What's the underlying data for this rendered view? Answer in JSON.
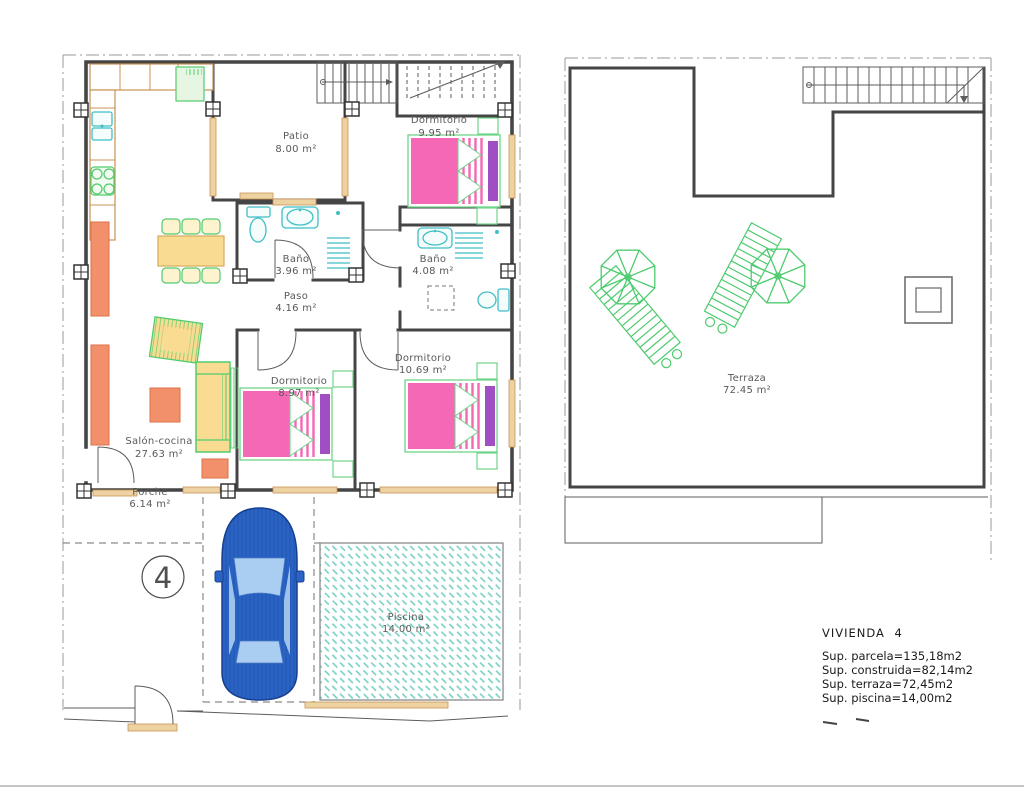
{
  "ground_floor": {
    "plot_number": "4",
    "rooms": [
      {
        "name": "Patio",
        "area": "8.00 m²"
      },
      {
        "name": "Dormitorio",
        "area": "9.95 m²"
      },
      {
        "name": "Baño",
        "area": "3.96 m²"
      },
      {
        "name": "Baño",
        "area": "4.08 m²"
      },
      {
        "name": "Paso",
        "area": "4.16 m²"
      },
      {
        "name": "Dormitorio",
        "area": "8.97 m²"
      },
      {
        "name": "Dormitorio",
        "area": "10.69 m²"
      },
      {
        "name": "Salón-cocina",
        "area": "27.63 m²"
      },
      {
        "name": "Porche",
        "area": "6.14 m²"
      },
      {
        "name": "Piscina",
        "area": "14.00 m²"
      }
    ]
  },
  "roof_plan": {
    "rooms": [
      {
        "name": "Terraza",
        "area": "72.45 m²"
      }
    ]
  },
  "summary": {
    "title": "VIVIENDA 4",
    "lines": [
      "Sup. parcela=135,18m2",
      "Sup. construida=82,14m2",
      "Sup. terraza=72,45m2",
      "Sup. piscina=14,00m2"
    ]
  },
  "colors": {
    "wall": "#454545",
    "wood_tan": "#eed3a2",
    "furniture_green": "#52cc6e",
    "fixture_teal": "#3fbfc5",
    "bed_pink": "#f468b5",
    "pillow_purple": "#a04ec4",
    "furniture_yellow": "#f9dc92",
    "furniture_orange": "#f2906b",
    "car_blue": "#2b63c4",
    "pool_teal": "#76cfc5"
  }
}
